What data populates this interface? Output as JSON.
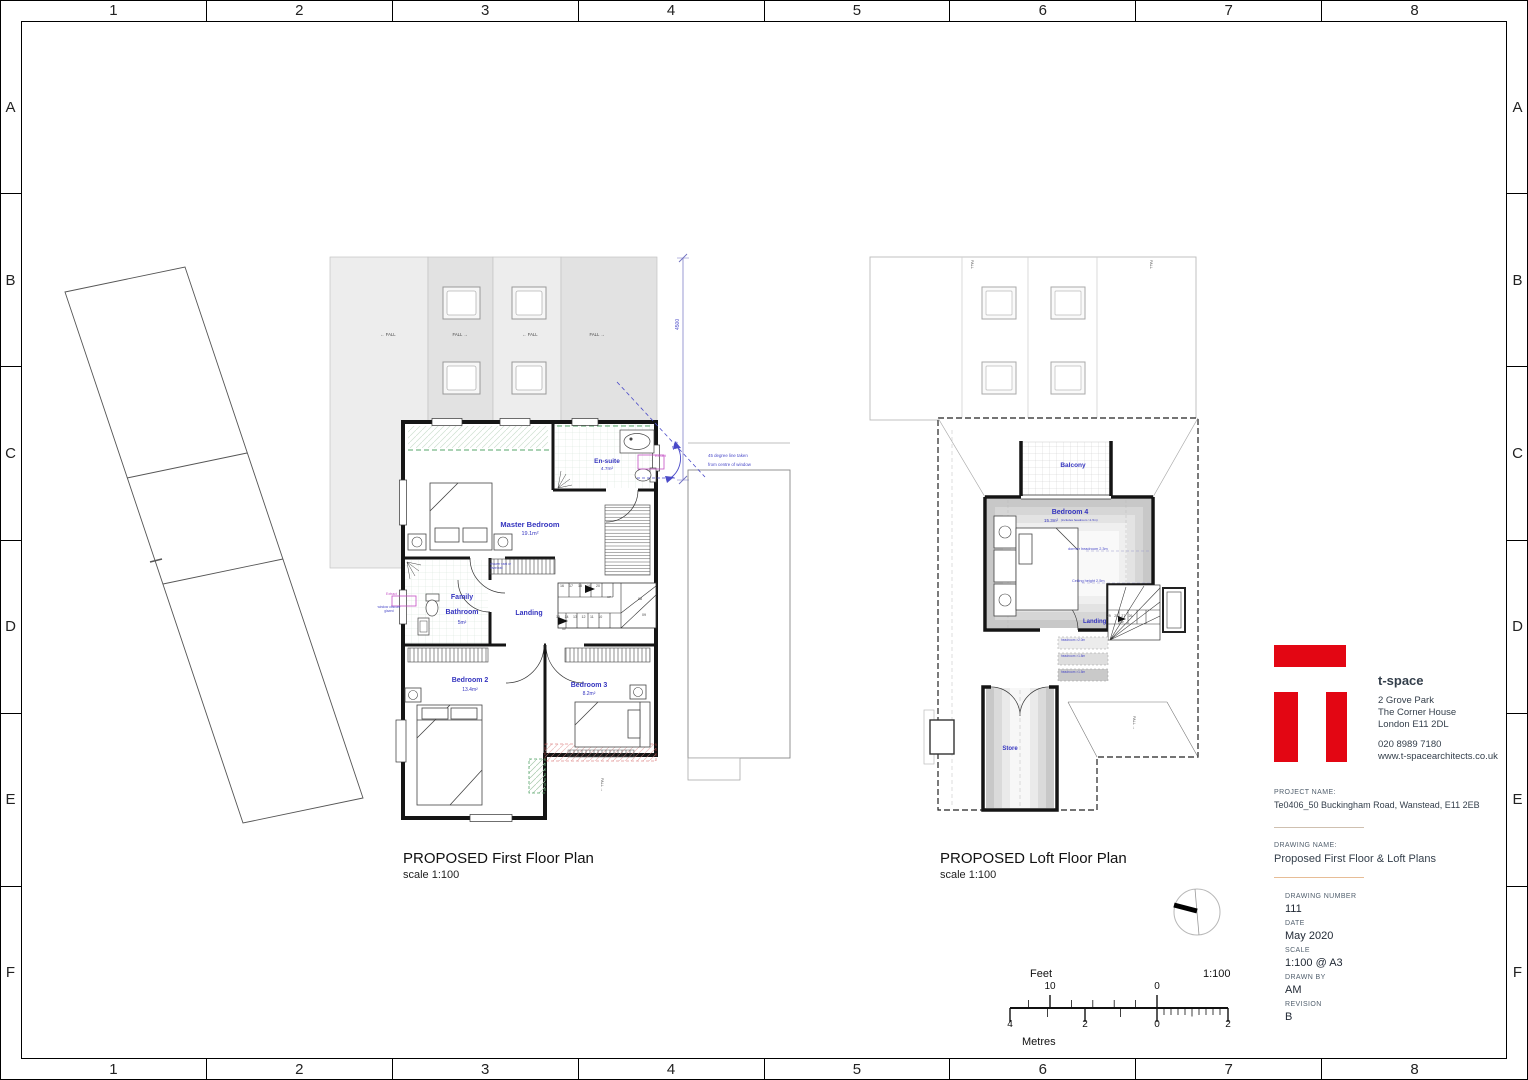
{
  "colors": {
    "logo_red": "#e30613",
    "annotation_blue": "#3434bf",
    "extract_magenta": "#c44fc4"
  },
  "border": {
    "columns": [
      "1",
      "2",
      "3",
      "4",
      "5",
      "6",
      "7",
      "8"
    ],
    "rows": [
      "A",
      "B",
      "C",
      "D",
      "E",
      "F"
    ]
  },
  "first_floor": {
    "title": "PROPOSED First Floor Plan",
    "scale_note": "scale 1:100",
    "rooms": {
      "ensuite": {
        "name": "En-suite",
        "area": "4.7m²"
      },
      "master": {
        "name": "Master Bedroom",
        "area": "19.1m²"
      },
      "bathroom": {
        "name": "Family Bathroom",
        "area": "5m²"
      },
      "landing": {
        "name": "Landing"
      },
      "bedroom2": {
        "name": "Bedroom 2",
        "area": "13.4m²"
      },
      "bedroom3": {
        "name": "Bedroom 3",
        "area": "8.2m²"
      }
    },
    "stairs": {
      "upper_treads": "16 17 18 19 20",
      "lower_treads": "15 14 13 12 11 10",
      "winder_a": "08",
      "winder_b": "09",
      "up": "UP"
    },
    "notes": {
      "shower": "shower seat or towel rail",
      "extract": "Extract",
      "obscure_glazing": "window obscure glazed",
      "angle": "45°",
      "angle_note_line1": "45 degree line taken",
      "angle_note_line2": "from centre of window",
      "dimension": "4500"
    },
    "fall_left": "← FALL",
    "fall_right": "FALL →",
    "fall": "FALL"
  },
  "loft": {
    "title": "PROPOSED Loft Floor Plan",
    "scale_note": "scale 1:100",
    "rooms": {
      "balcony": {
        "name": "Balcony"
      },
      "bedroom4": {
        "name": "Bedroom 4",
        "area": "15.3m²",
        "area_note": "(includes headroom >1.5m)"
      },
      "landing": {
        "name": "Landing"
      },
      "store": {
        "name": "Store"
      }
    },
    "stairs": {
      "treads": "29 28 27 26",
      "up": "UP"
    },
    "notes": {
      "dormer": "dormer headroom 2.3m",
      "ceiling": "Ceiling height 2.5m",
      "headroom_1": "headroom >2.0m",
      "headroom_2": "headroom >1.8m",
      "headroom_3": "headroom >1.5m"
    }
  },
  "titleblock": {
    "brand": "t-space",
    "address_line1": "2 Grove Park",
    "address_line2": "The Corner House",
    "address_line3": "London E11 2DL",
    "phone": "020 8989 7180",
    "website": "www.t-spacearchitects.co.uk",
    "project_label": "PROJECT NAME:",
    "project_name": "Te0406_50 Buckingham Road, Wanstead, E11 2EB",
    "drawing_label": "DRAWING NAME:",
    "drawing_name": "Proposed First Floor & Loft Plans",
    "fields": [
      {
        "label": "DRAWING NUMBER",
        "value": "111"
      },
      {
        "label": "DATE",
        "value": "May 2020"
      },
      {
        "label": "SCALE",
        "value": "1:100 @ A3"
      },
      {
        "label": "DRAWN BY",
        "value": "AM"
      },
      {
        "label": "REVISION",
        "value": "B"
      }
    ]
  },
  "scalebar": {
    "feet_label": "Feet",
    "metres_label": "Metres",
    "ratio": "1:100",
    "feet_10": "10",
    "feet_0": "0",
    "m_4": "4",
    "m_2l": "2",
    "m_0": "0",
    "m_2r": "2"
  }
}
